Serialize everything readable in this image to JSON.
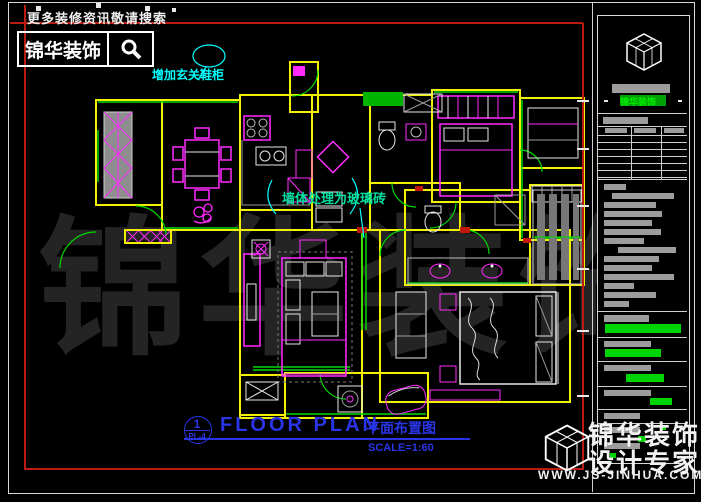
{
  "header": {
    "search_hint": "更多装修资讯敬请搜索",
    "logo_text": "锦华装饰",
    "search_icon": "magnifier-icon"
  },
  "annotations": {
    "entry": {
      "text": "增加玄关鞋柜",
      "color": "#00ffff"
    },
    "partition": {
      "text": "墙体处理为玻璃砖",
      "color": "#00e0a0"
    }
  },
  "plan_title": {
    "number": "1",
    "ref": "PL-4",
    "title_en": "FLOOR PLAN",
    "title_zh": "平面布置图",
    "scale": "SCALE=1:60"
  },
  "title_block": {
    "company_green": "锦华装饰"
  },
  "watermark": {
    "plan_text": "锦华装饰",
    "brand_line1": "锦华装饰",
    "brand_line2": "设计专家",
    "website": "WWW.JS-JINHUA.COM"
  },
  "colors": {
    "wall_yellow": "#f2f200",
    "furniture_magenta": "#ff2bff",
    "accent_green": "#00d800",
    "fixture_cyan": "#00ffff",
    "frame_red": "#b81c12",
    "title_blue": "#2a35e8",
    "value_green": "#00d400",
    "redacted_gray": "#9c9c9c",
    "watermark_gray": "#242424"
  }
}
